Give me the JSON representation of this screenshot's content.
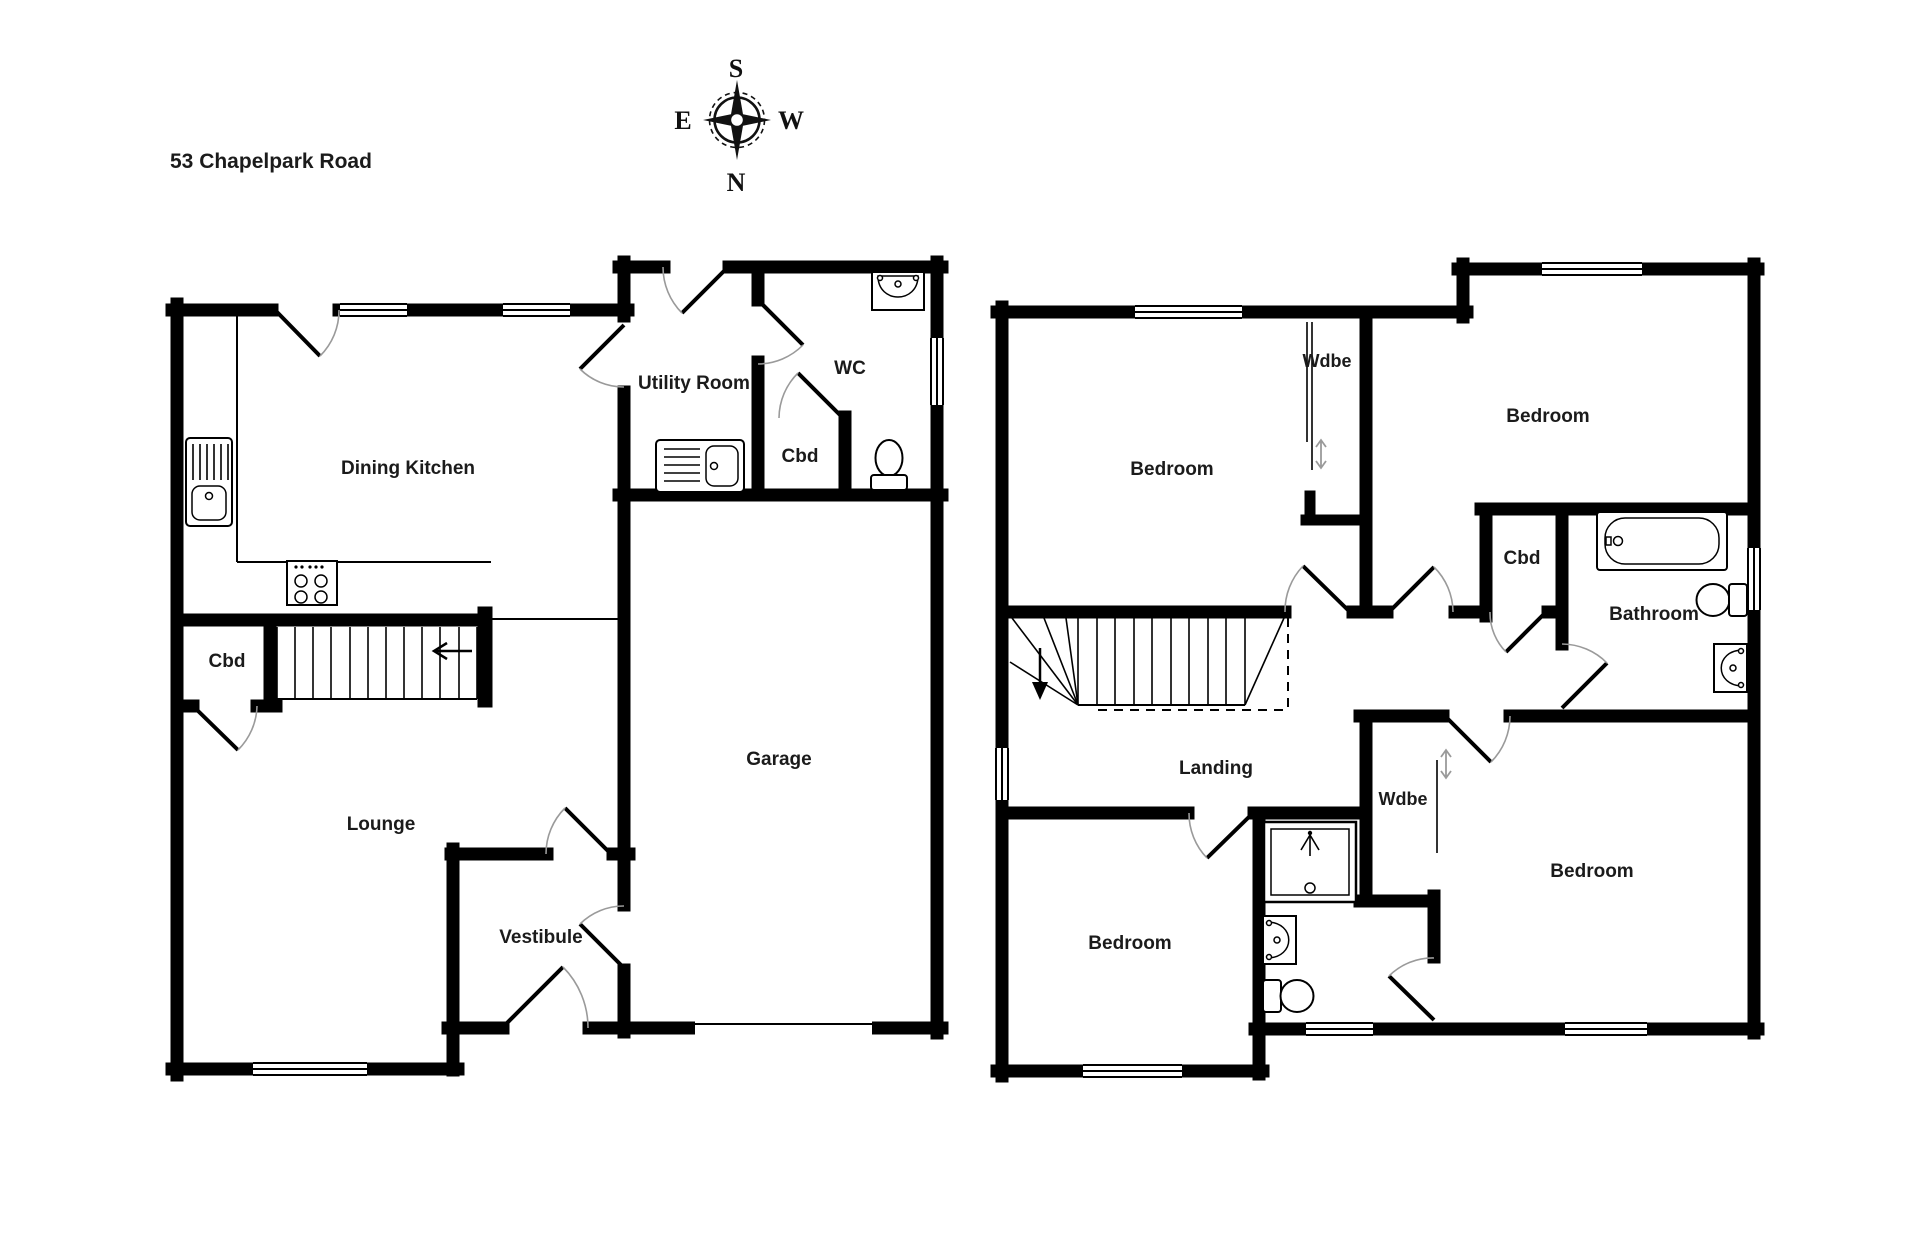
{
  "title": "53 Chapelpark Road",
  "compass": {
    "top": "S",
    "bottom": "N",
    "left": "E",
    "right": "W"
  },
  "ground_floor": {
    "rooms": {
      "dining_kitchen": "Dining Kitchen",
      "utility_room": "Utility Room",
      "wc": "WC",
      "wc_cupboard": "Cbd",
      "stairs_cupboard": "Cbd",
      "lounge": "Lounge",
      "vestibule": "Vestibule",
      "garage": "Garage"
    }
  },
  "first_floor": {
    "rooms": {
      "bedroom_nw": "Bedroom",
      "bedroom_ne": "Bedroom",
      "bedroom_sw": "Bedroom",
      "bedroom_se": "Bedroom",
      "wardrobe_n": "Wdbe",
      "wardrobe_s": "Wdbe",
      "cupboard": "Cbd",
      "bathroom": "Bathroom",
      "landing": "Landing"
    }
  }
}
